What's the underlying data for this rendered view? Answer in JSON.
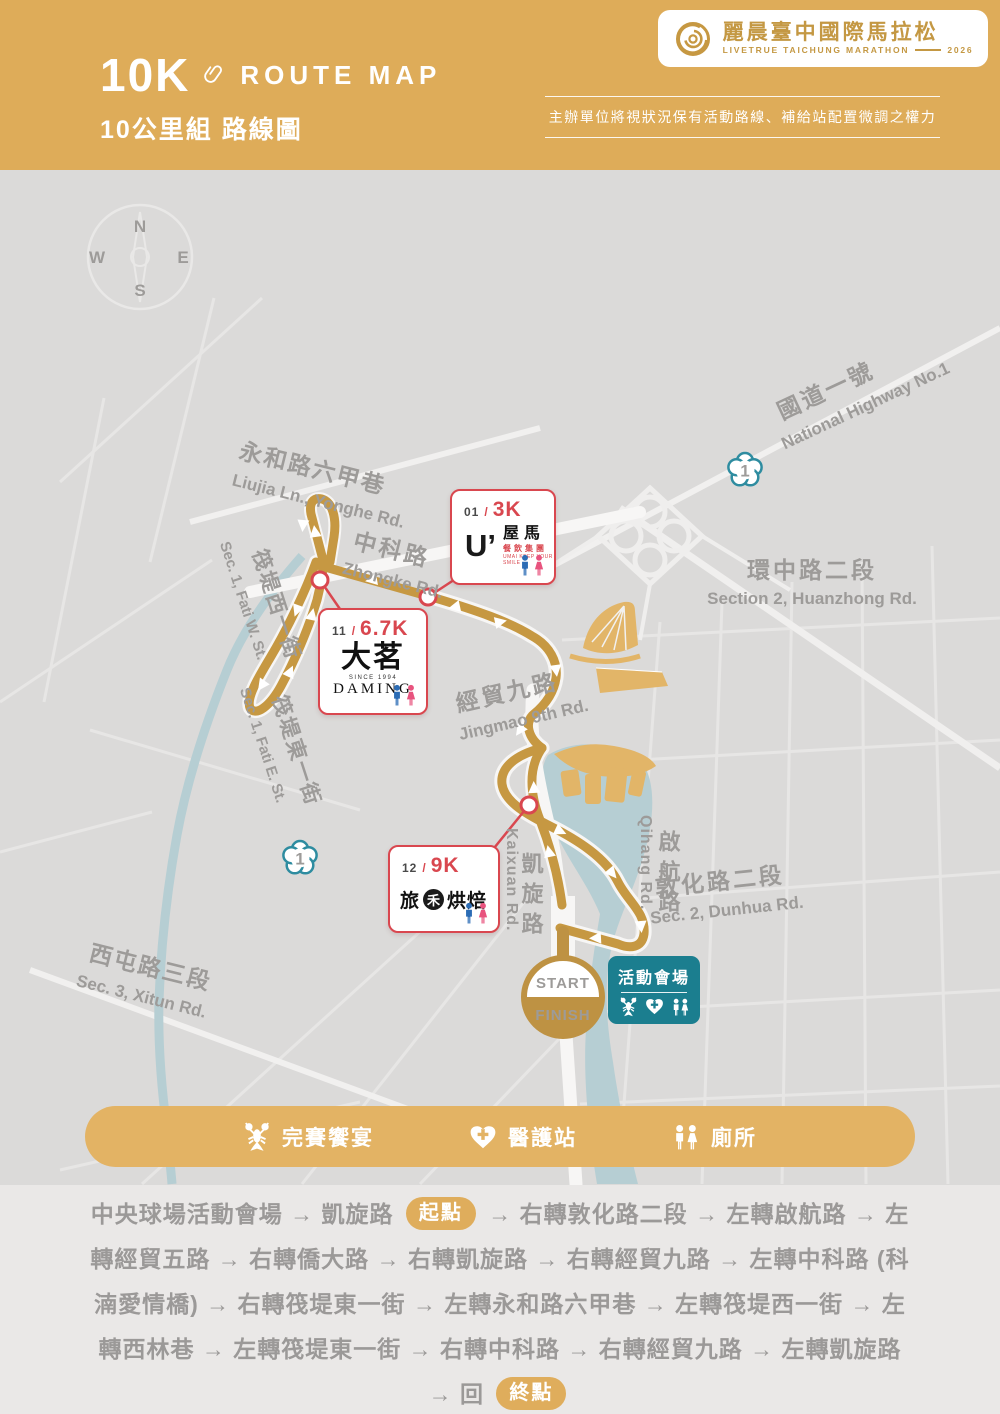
{
  "header": {
    "distance": "10K",
    "route_map_label": "ROUTE MAP",
    "subtitle_zh": "10公里組 路線圖",
    "brand_zh": "麗晨臺中國際馬拉松",
    "brand_en": "LIVETRUE TAICHUNG MARATHON",
    "brand_year": "2026",
    "disclaimer": "主辦單位將視狀況保有活動路線、補給站配置微調之權力"
  },
  "map": {
    "compass": {
      "n": "N",
      "e": "E",
      "s": "S",
      "w": "W"
    },
    "highway_badge": "1",
    "roads": [
      {
        "zh": "國道一號",
        "en": "National Highway No.1"
      },
      {
        "zh": "永和路六甲巷",
        "en": "Liujia Ln., Yonghe Rd."
      },
      {
        "zh": "中科路",
        "en": "Zhongke Rd."
      },
      {
        "zh": "筏堤西一街",
        "en": "Sec. 1, Fati W. St."
      },
      {
        "zh": "筏堤東一街",
        "en": "Sec. 1, Fati E. St."
      },
      {
        "zh": "經貿九路",
        "en": "Jingmao 9th Rd."
      },
      {
        "zh": "環中路二段",
        "en": "Section 2, Huanzhong Rd."
      },
      {
        "zh": "凱旋路",
        "en": "Kaixuan Rd."
      },
      {
        "zh": "啟航路",
        "en": "Qihang Rd."
      },
      {
        "zh": "敦化路二段",
        "en": "Sec. 2, Dunhua Rd."
      },
      {
        "zh": "西屯路三段",
        "en": "Sec. 3, Xitun Rd."
      }
    ],
    "checkpoints": [
      {
        "num": "01",
        "sep": "/",
        "dist": "3K",
        "logo_mark": "U’",
        "logo_zh": "屋馬",
        "logo_sub": "餐飲集團",
        "tagline": "UMAI KEEP YOUR SMILE"
      },
      {
        "num": "11",
        "sep": "/",
        "dist": "6.7K",
        "logo_zh": "大茗",
        "since": "SINCE 1994",
        "logo_en": "DAMING"
      },
      {
        "num": "12",
        "sep": "/",
        "dist": "9K",
        "logo_pre": "旅",
        "logo_circle": "禾",
        "logo_post": "烘焙"
      }
    ],
    "start_finish": {
      "start": "START",
      "finish": "FINISH"
    },
    "venue_label": "活動會場"
  },
  "legend": {
    "items": [
      {
        "icon": "lobster-icon",
        "label": "完賽饗宴"
      },
      {
        "icon": "medical-heart-icon",
        "label": "醫護站"
      },
      {
        "icon": "restroom-icon",
        "label": "廁所"
      }
    ]
  },
  "directions": {
    "lead": "中央球場活動會場 → 凱旋路 ",
    "start_badge": "起點",
    "rest": " → 右轉敦化路二段 → 左轉啟航路 → 左轉經貿五路 → 右轉僑大路 → 右轉凱旋路 → 右轉經貿九路 → 左轉中科路 (科湳愛情橋) → 右轉筏堤東一街 → 左轉永和路六甲巷 → 左轉筏堤西一街 → 左轉西林巷 → 左轉筏堤東一街 → 右轉中科路 → 右轉經貿九路 → 左轉凱旋路 → 回 ",
    "end_badge": "終點"
  }
}
